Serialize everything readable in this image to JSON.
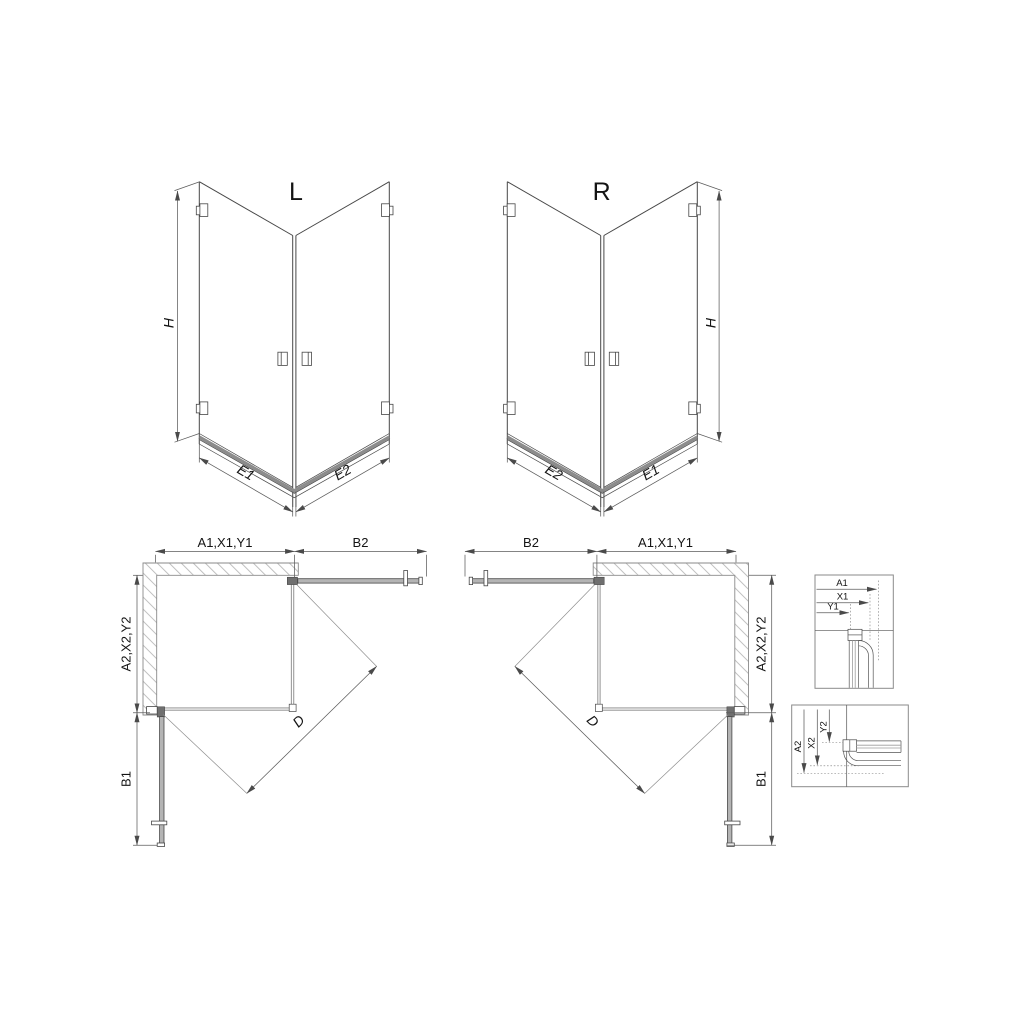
{
  "colors": {
    "background": "#ffffff",
    "line": "#474747",
    "dim": "#5c5c5c",
    "glass": "#9c9c9c",
    "band": "#8c8c8c",
    "wall": "#8a8a8a",
    "hatch": "#b0b0b0",
    "door_fill": "#b4b4b4",
    "hinge_fill": "#6f6f6f",
    "text": "#141414"
  },
  "iso_left": {
    "label": "L",
    "h": "H",
    "e_left": "E1",
    "e_right": "E2"
  },
  "iso_right": {
    "label": "R",
    "h": "H",
    "e_left": "E2",
    "e_right": "E1"
  },
  "plan_left": {
    "top_panel": "A1,X1,Y1",
    "top_door": "B2",
    "side_panel": "A2,X2,Y2",
    "side_door": "B1",
    "entry": "D"
  },
  "plan_right": {
    "top_door": "B2",
    "top_panel": "A1,X1,Y1",
    "side_panel": "A2,X2,Y2",
    "side_door": "B1",
    "entry": "D"
  },
  "detail_width": {
    "a": "A1",
    "x": "X1",
    "y": "Y1"
  },
  "detail_depth": {
    "a": "A2",
    "x": "X2",
    "y": "Y2"
  }
}
